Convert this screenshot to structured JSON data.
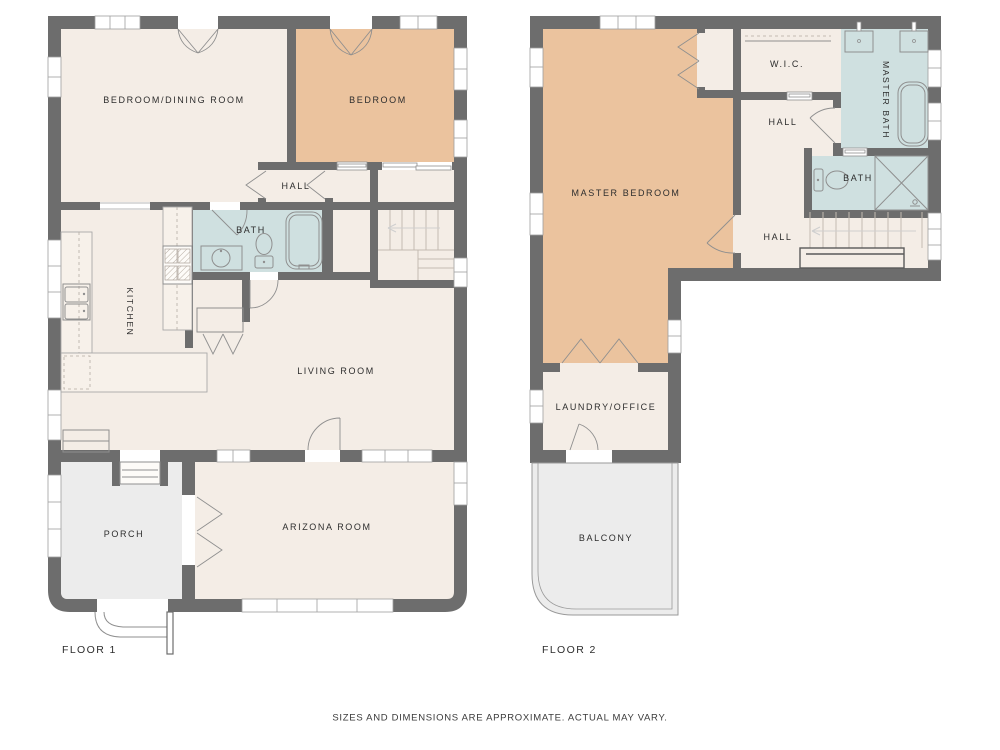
{
  "page": {
    "background": "#ffffff"
  },
  "colors": {
    "wall": "#6d6d6d",
    "room_cream": "#f4ede6",
    "room_tan": "#ebc39e",
    "room_bath_blue": "#cfe0e0",
    "outdoor_gray": "#ececec",
    "fixture_line": "#8f8f8f",
    "stair_line": "#c4bab1",
    "door_line": "#8f8f8f",
    "window_line": "#9f9f9f",
    "label_text": "#2d2d2d"
  },
  "floor1": {
    "caption": "FLOOR 1",
    "rooms": [
      {
        "id": "bedroom-dining-room",
        "label": "BEDROOM/DINING ROOM"
      },
      {
        "id": "bedroom",
        "label": "BEDROOM"
      },
      {
        "id": "hall",
        "label": "HALL"
      },
      {
        "id": "bath",
        "label": "BATH"
      },
      {
        "id": "kitchen",
        "label": "KITCHEN"
      },
      {
        "id": "living-room",
        "label": "LIVING ROOM"
      },
      {
        "id": "arizona-room",
        "label": "ARIZONA ROOM"
      },
      {
        "id": "porch",
        "label": "PORCH"
      }
    ]
  },
  "floor2": {
    "caption": "FLOOR 2",
    "rooms": [
      {
        "id": "master-bedroom",
        "label": "MASTER BEDROOM"
      },
      {
        "id": "wic",
        "label": "W.I.C."
      },
      {
        "id": "hall-upper",
        "label": "HALL"
      },
      {
        "id": "master-bath",
        "label": "MASTER BATH"
      },
      {
        "id": "bath",
        "label": "BATH"
      },
      {
        "id": "hall-lower",
        "label": "HALL"
      },
      {
        "id": "laundry-office",
        "label": "LAUNDRY/OFFICE"
      },
      {
        "id": "balcony",
        "label": "BALCONY"
      }
    ]
  },
  "footer": {
    "disclaimer": "SIZES AND DIMENSIONS ARE APPROXIMATE. ACTUAL MAY VARY."
  }
}
